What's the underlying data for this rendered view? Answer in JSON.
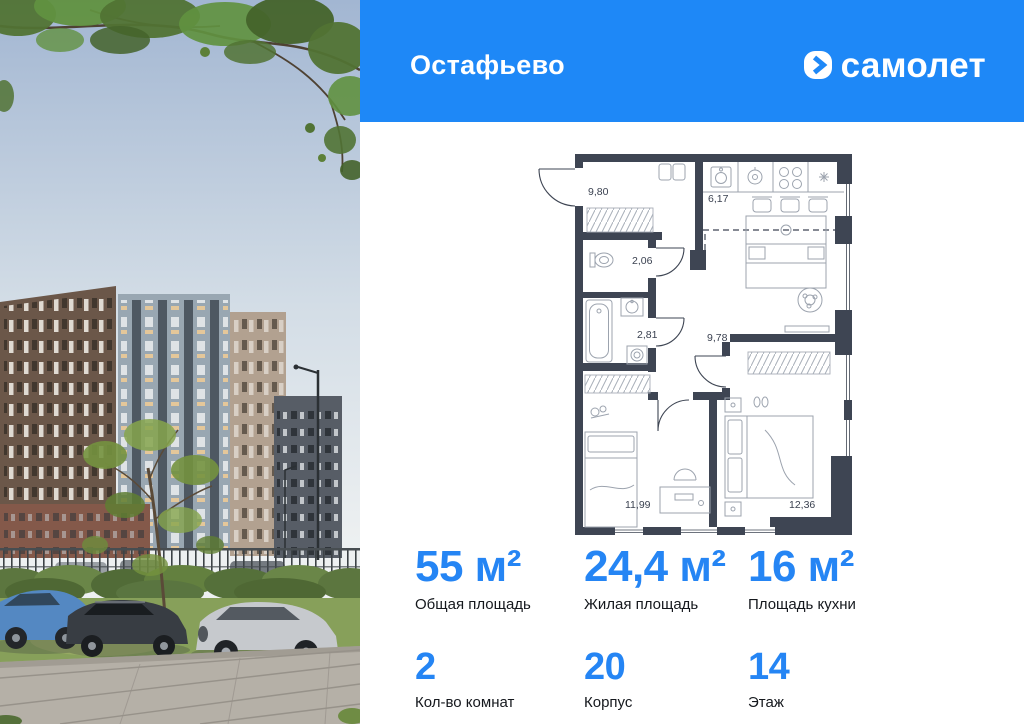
{
  "header": {
    "project_title": "Остафьево",
    "brand_name": "самолет",
    "brand_icon": "chevron-plane-in-rounded-square"
  },
  "floor_plan": {
    "area_labels": [
      "9,80",
      "6,17",
      "2,06",
      "2,81",
      "9,78",
      "11,99",
      "12,36"
    ]
  },
  "stats": [
    {
      "value": "55 м²",
      "label": "Общая площадь"
    },
    {
      "value": "24,4 м²",
      "label": "Жилая площадь"
    },
    {
      "value": "16 м²",
      "label": "Площадь кухни"
    },
    {
      "value": "2",
      "label": "Кол-во комнат"
    },
    {
      "value": "20",
      "label": "Корпус"
    },
    {
      "value": "14",
      "label": "Этаж"
    }
  ],
  "colors": {
    "accent_blue": "#1E88F7",
    "stat_number_blue": "#2585F4",
    "plan_wall": "#3E4553"
  }
}
